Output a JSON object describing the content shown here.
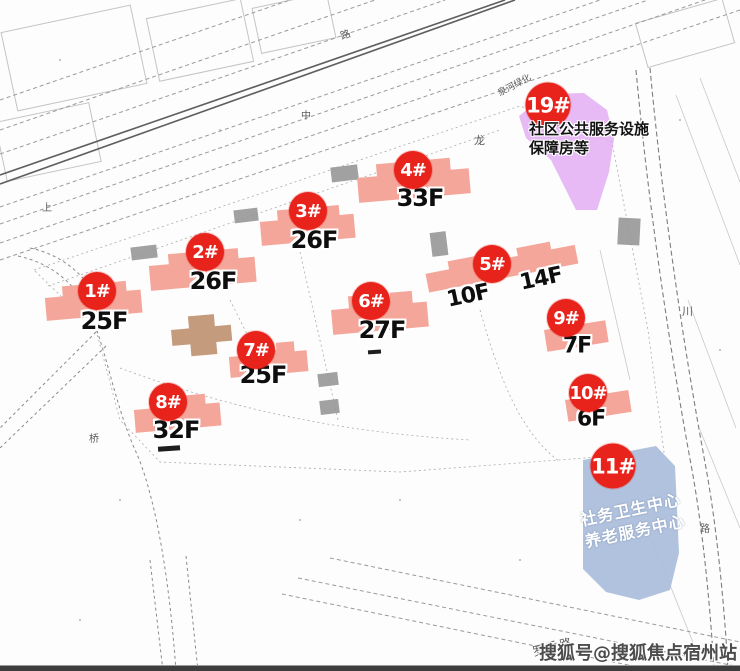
{
  "markers": [
    {
      "id": "1#",
      "floor": "25F"
    },
    {
      "id": "2#",
      "floor": "26F"
    },
    {
      "id": "3#",
      "floor": "26F"
    },
    {
      "id": "4#",
      "floor": "33F"
    },
    {
      "id": "6#",
      "floor": "27F"
    },
    {
      "id": "7#",
      "floor": "25F"
    },
    {
      "id": "8#",
      "floor": "32F"
    },
    {
      "id": "9#",
      "floor": "7F"
    },
    {
      "id": "10#",
      "floor": "6F"
    }
  ],
  "marker5": {
    "id": "5#",
    "floor_left": "10F",
    "floor_right": "14F"
  },
  "zones": {
    "public_service": {
      "id": "19#",
      "line1": "社区公共服务设施",
      "line2": "保障房等"
    },
    "health_center": {
      "id": "11#",
      "line1": "社务卫生中心",
      "line2": "养老服务中心"
    }
  },
  "map_labels": {
    "greenbelt": "泉河绿化",
    "road_bottom": "罗香路",
    "char_long": "龙",
    "char_chuan": "川",
    "char_lu_right": "路",
    "char_zhong": "中",
    "char_shang": "上",
    "char_qiao": "桥",
    "char_lu_top": "路"
  },
  "watermark": "搜狐号@搜狐焦点宿州站",
  "colors": {
    "badge_red": "#e8231c",
    "building_pink": "#f4a69a",
    "clubhouse_tan": "#c49b7d",
    "zone_purple": "#e0a6f2",
    "zone_blue": "#a9bdda"
  }
}
